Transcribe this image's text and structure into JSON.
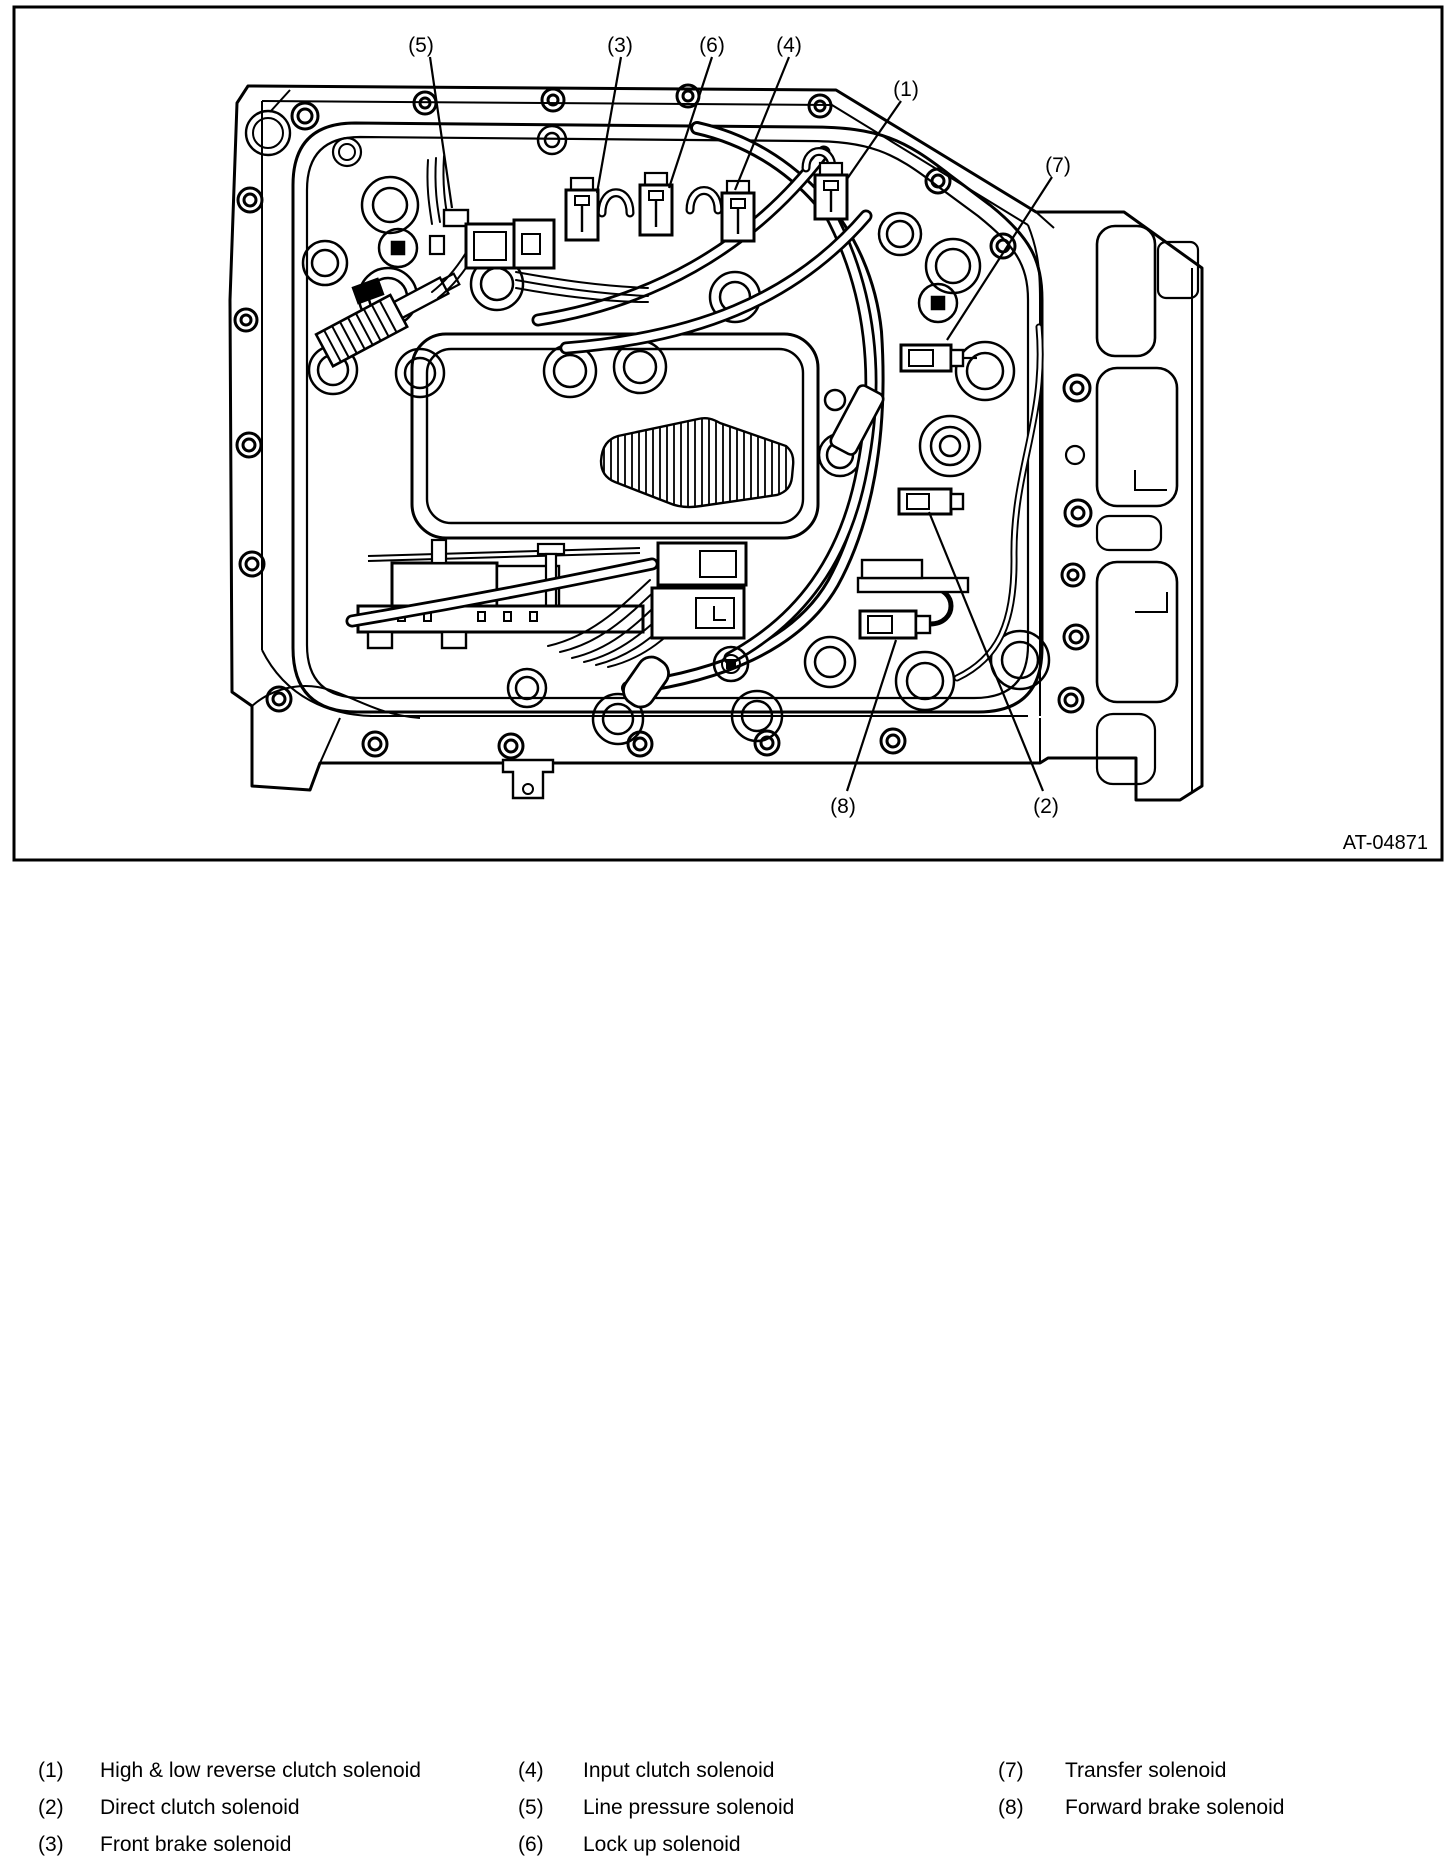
{
  "figure": {
    "reference_code": "AT-04871",
    "callouts": {
      "c1": "(1)",
      "c2": "(2)",
      "c3": "(3)",
      "c4": "(4)",
      "c5": "(5)",
      "c6": "(6)",
      "c7": "(7)",
      "c8": "(8)"
    }
  },
  "legend": {
    "items": [
      {
        "num": "(1)",
        "label": "High & low reverse clutch solenoid"
      },
      {
        "num": "(2)",
        "label": "Direct clutch solenoid"
      },
      {
        "num": "(3)",
        "label": "Front brake solenoid"
      },
      {
        "num": "(4)",
        "label": "Input clutch solenoid"
      },
      {
        "num": "(5)",
        "label": "Line pressure solenoid"
      },
      {
        "num": "(6)",
        "label": "Lock up solenoid"
      },
      {
        "num": "(7)",
        "label": "Transfer solenoid"
      },
      {
        "num": "(8)",
        "label": "Forward brake solenoid"
      }
    ]
  }
}
